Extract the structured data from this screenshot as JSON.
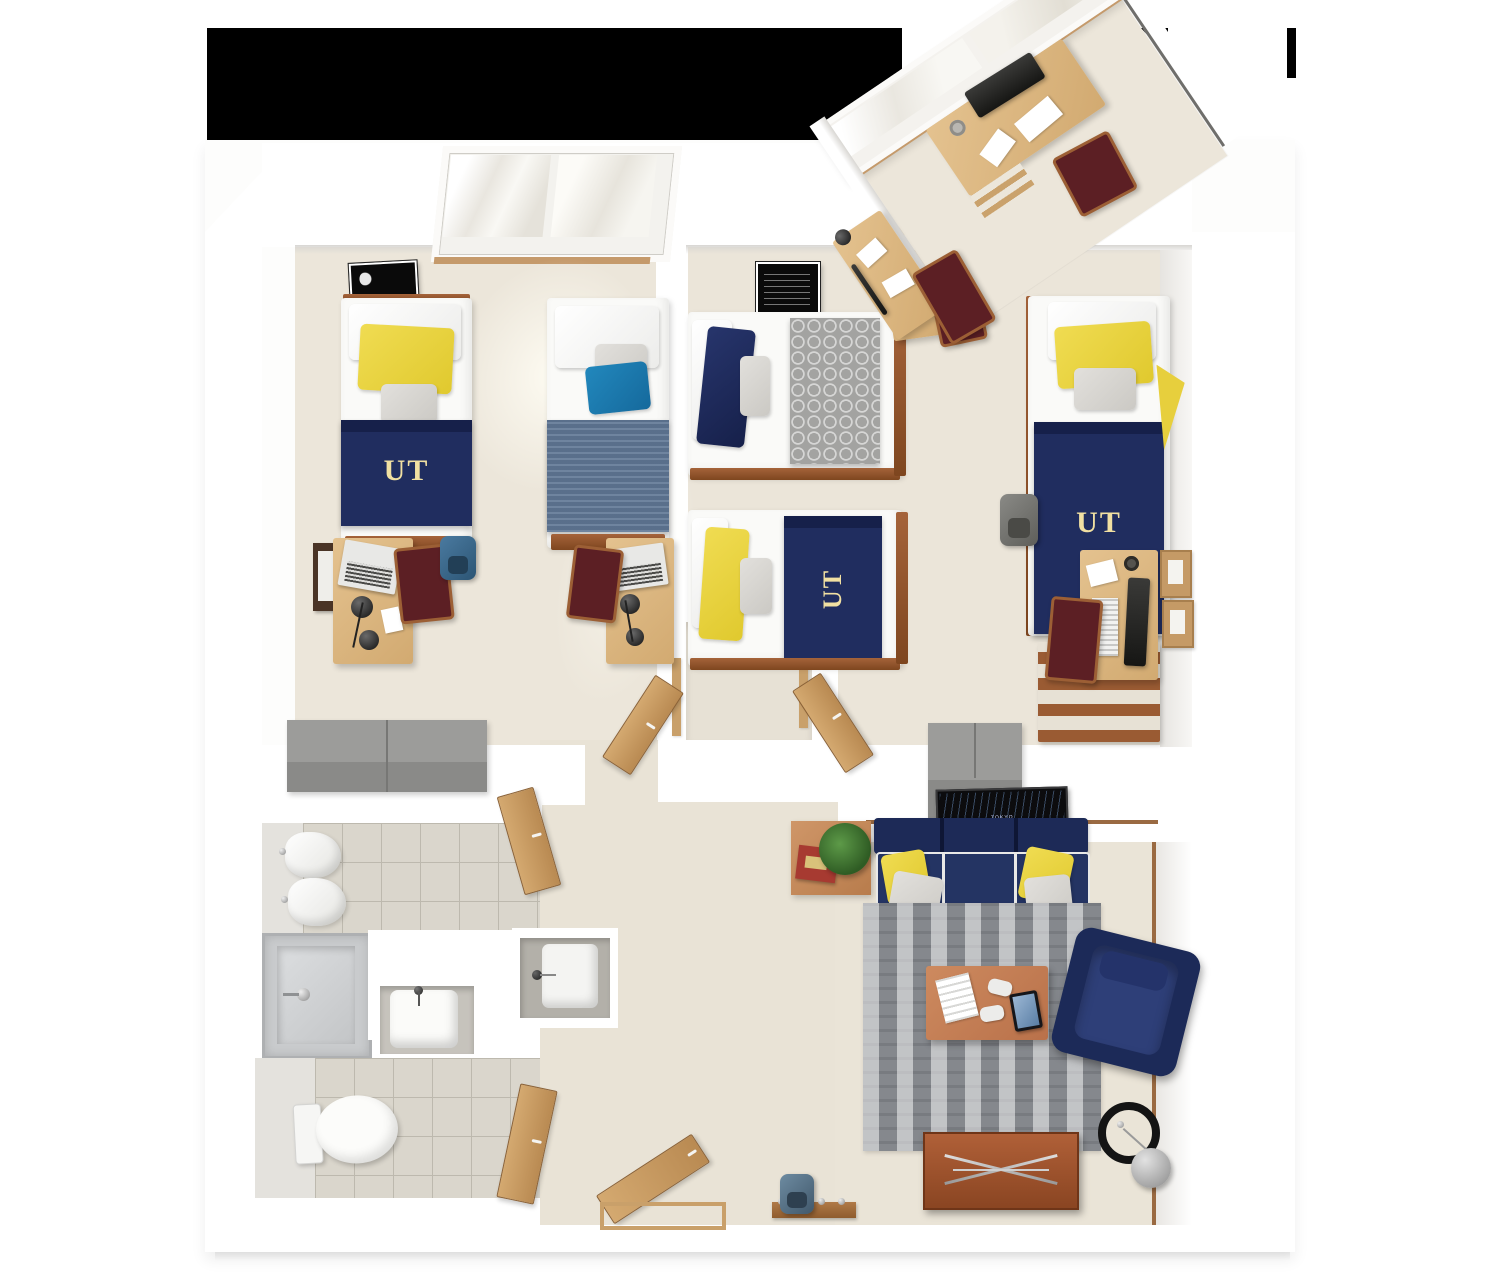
{
  "title": "UT residence hall suite — 3D top-down floor plan",
  "texts": {
    "ut": "UT",
    "jupiter": "JUPITER",
    "tokyo": "TOKYO"
  },
  "palette": {
    "backdrop_black": "#000000",
    "wall_white": "#ffffff",
    "floor_beige": "#ebe5d9",
    "tile_gray": "#dad6cc",
    "navy": "#202d5f",
    "ut_gold": "#f1e0a2",
    "pillow_yellow": "#e9d43f",
    "pillow_blue": "#1a7fb5",
    "denim_blue": "#5f7694",
    "throw_gray": "#a3a3a1",
    "chair_maroon": "#5c1f24",
    "wood_light": "#ddb887",
    "wood_frame": "#9a5b33",
    "door_wood": "#c9a06a",
    "dresser_gray": "#9c9c9a",
    "rug_gray": "#85888d",
    "sofa_navy": "#1d2a57",
    "table_terracotta": "#c5805a"
  },
  "rooms": {
    "bedroom_left": {
      "name": "Bedroom A",
      "furniture": [
        "twin bed with UT navy bedding",
        "twin bed with denim bedding",
        "window",
        "Jupiter poster",
        "wall board",
        "desk with laptop and lamp",
        "second desk with laptop and lamp",
        "two maroon chairs",
        "blue backpack",
        "gray wardrobe dressers"
      ]
    },
    "bedroom_middle": {
      "name": "Bedroom B",
      "furniture": [
        "twin bed with gray quatrefoil throw",
        "twin bed with UT navy bedding",
        "patent poster",
        "desk with papers",
        "maroon chair"
      ]
    },
    "study_nook": {
      "name": "Study nook",
      "furniture": [
        "corner window",
        "desk with monitor and papers",
        "second desk with lamp",
        "two maroon chairs"
      ]
    },
    "bedroom_right": {
      "name": "Bedroom C",
      "furniture": [
        "twin bed with UT navy bedding",
        "yellow pennant",
        "desk with monitor and keyboard",
        "maroon chair",
        "two cork boards",
        "gray dresser",
        "gray backpack"
      ]
    },
    "bathroom": {
      "name": "Bathroom",
      "furniture": [
        "two towels on hooks",
        "shower",
        "vanity sink",
        "hall sink niche",
        "toilet",
        "doors"
      ]
    },
    "hallway": {
      "name": "Hallway",
      "furniture": [
        "closet nook",
        "two wooden doors",
        "entry door",
        "coat rack with backpack"
      ]
    },
    "living_room": {
      "name": "Living room",
      "furniture": [
        "Tokyo map wall art",
        "side table with plant and books",
        "navy sofa with yellow and gray pillows",
        "striped area rug",
        "coffee table with book, game controllers and tablet",
        "navy armchair",
        "media console",
        "arc floor lamp"
      ]
    }
  }
}
